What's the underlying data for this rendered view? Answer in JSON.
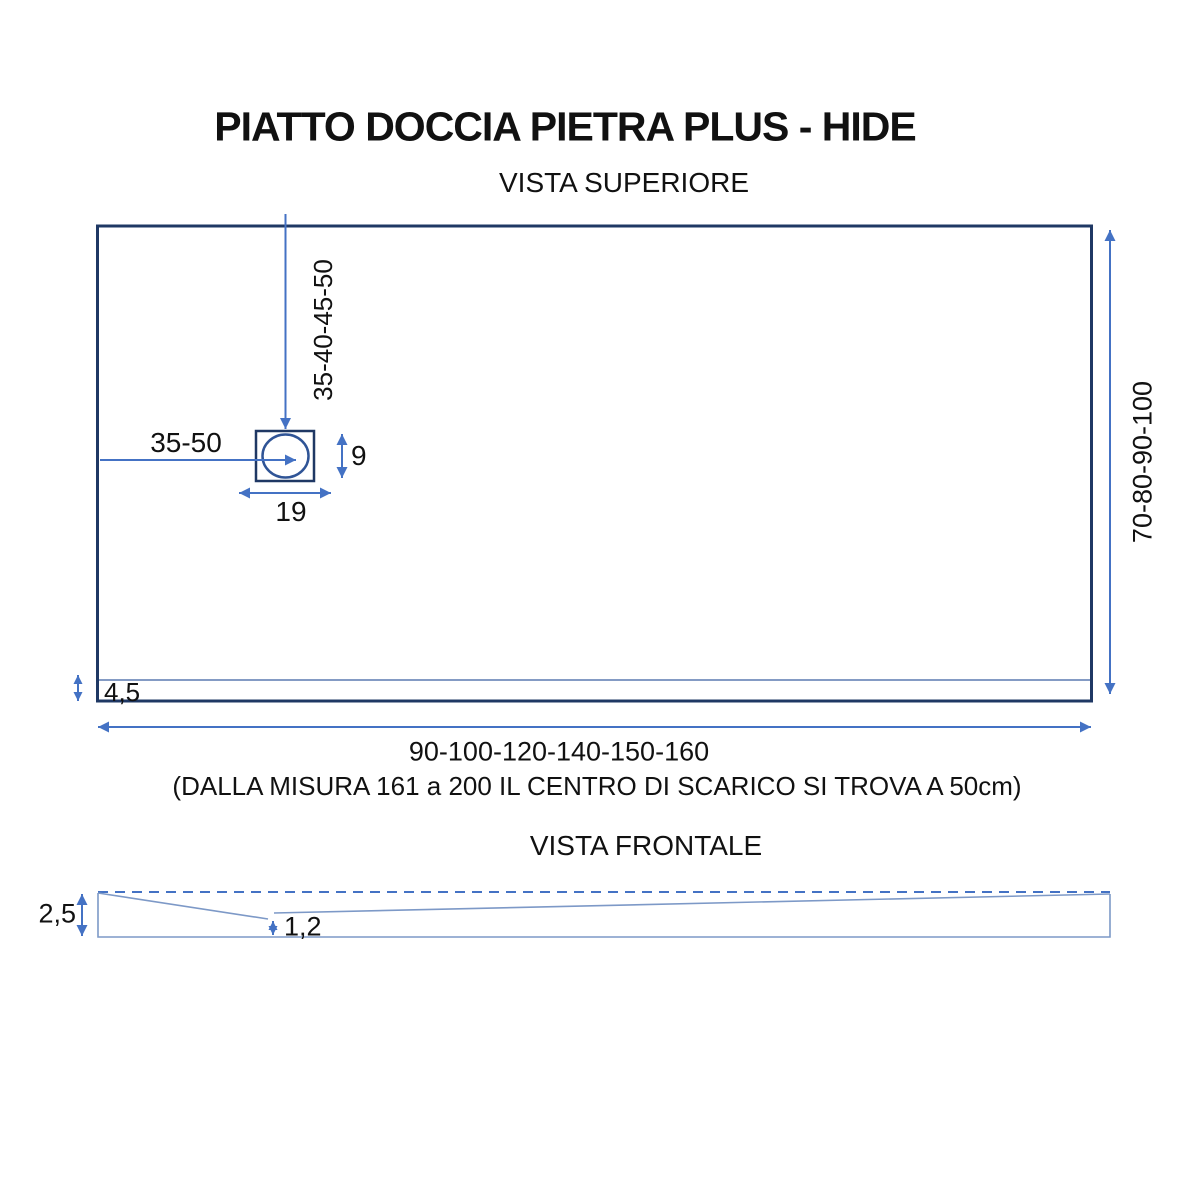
{
  "page": {
    "title": "PIATTO DOCCIA PIETRA PLUS - HIDE"
  },
  "top_view": {
    "heading": "VISTA SUPERIORE",
    "dims": {
      "drain_center_from_top": "35-40-45-50",
      "drain_center_from_left": "35-50",
      "drain_box_height": "9",
      "drain_box_width": "19",
      "tray_depths": "70-80-90-100",
      "edge_band": "4,5",
      "tray_widths": "90-100-120-140-150-160",
      "widths_note": "(DALLA MISURA 161 a 200 IL CENTRO DI SCARICO SI TROVA A 50cm)"
    }
  },
  "front_view": {
    "heading": "VISTA FRONTALE",
    "dims": {
      "edge_thickness": "2,5",
      "drain_point_thickness": "1,2"
    }
  },
  "colors": {
    "outline_dark": "#1f3864",
    "dimension_blue": "#4472c4",
    "circle_blue": "#2f5496",
    "light_line": "#7d99c7",
    "inner_line": "#5b7ab0",
    "text": "#111111"
  }
}
